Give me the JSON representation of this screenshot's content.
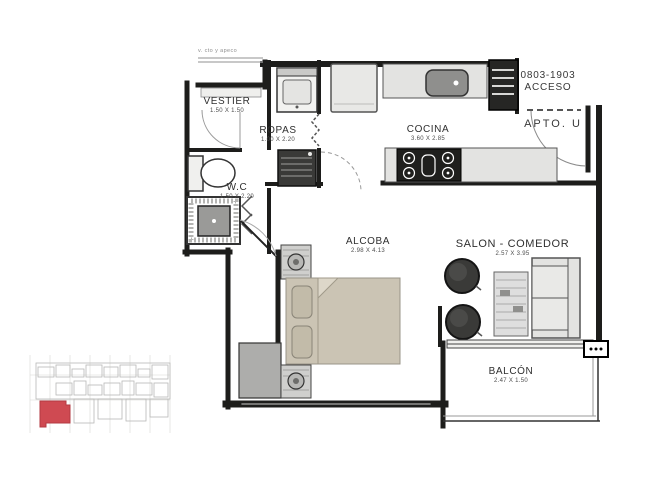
{
  "plan": {
    "rooms": {
      "vestier": {
        "label": "VESTIER",
        "dims": "1.50 X 1.50"
      },
      "ropas": {
        "label": "ROPAS",
        "dims": "1.00 X 2.20"
      },
      "cocina": {
        "label": "COCINA",
        "dims": "3.60 X 2.85"
      },
      "wc": {
        "label": "W.C",
        "dims": "1.50 X 2.20"
      },
      "alcoba": {
        "label": "ALCOBA",
        "dims": "2.98 X 4.13"
      },
      "salon_comedor": {
        "label": "SALON - COMEDOR",
        "dims": "2.57 X 3.95"
      },
      "balcon": {
        "label": "BALCÓN",
        "dims": "2.47 X 1.50"
      }
    },
    "entry": {
      "unit_range": "0803-1903",
      "access_label": "ACCESO",
      "apartment_label": "APTO. U"
    },
    "annotations": {
      "window_note": "v. cto y apeco"
    },
    "colors": {
      "wall": "#1d1d1b",
      "counter": "#e3e3e1",
      "sink": "#8f8f8d",
      "bed": "#cbc4b4",
      "pillow": "#c2bba9",
      "chair_dark": "#3a3a38",
      "closet_block": "#adadab",
      "keyplan_line": "#c2c2c2",
      "keyplan_highlight": "#cf4a52"
    }
  }
}
